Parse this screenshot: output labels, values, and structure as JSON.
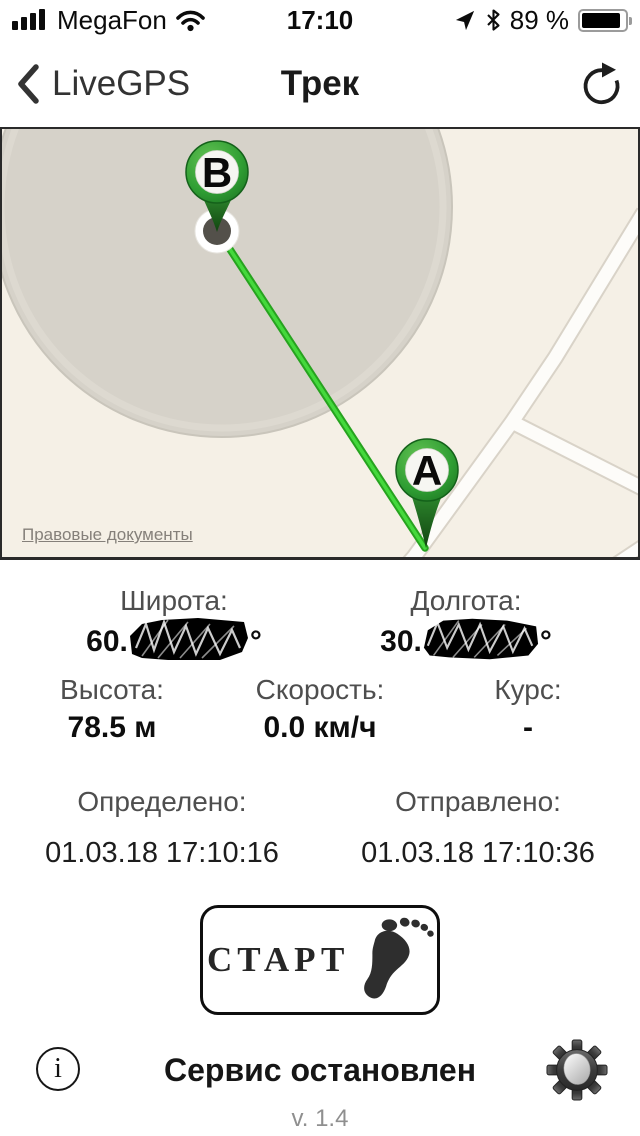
{
  "status_bar": {
    "carrier": "MegaFon",
    "time": "17:10",
    "battery_percent": "89 %"
  },
  "nav_bar": {
    "back_label": "LiveGPS",
    "title": "Трек"
  },
  "map": {
    "marker_b": "B",
    "marker_a": "A",
    "legal_link": "Правовые документы"
  },
  "coordinates": {
    "latitude": {
      "label": "Широта:",
      "visible_value": "60.",
      "unit": "°",
      "redacted": true
    },
    "longitude": {
      "label": "Долгота:",
      "visible_value": "30.",
      "unit": "°",
      "redacted": true
    }
  },
  "metrics": {
    "altitude": {
      "label": "Высота:",
      "value": "78.5 м"
    },
    "speed": {
      "label": "Скорость:",
      "value": "0.0 км/ч"
    },
    "course": {
      "label": "Курс:",
      "value": "-"
    }
  },
  "timestamps": {
    "fix": {
      "label": "Определено:",
      "value": "01.03.18 17:10:16"
    },
    "sent": {
      "label": "Отправлено:",
      "value": "01.03.18 17:10:36"
    }
  },
  "start_button": {
    "label": "СТАРТ"
  },
  "footer": {
    "status_text": "Сервис остановлен",
    "version": "v. 1.4",
    "info_glyph": "i"
  },
  "colors": {
    "pin_green": "#2f9e33",
    "track_green": "#3ad232",
    "map_background": "#f5f0e6",
    "accuracy_circle": "#d6d2c9",
    "road_fill": "#fdfcf9"
  }
}
